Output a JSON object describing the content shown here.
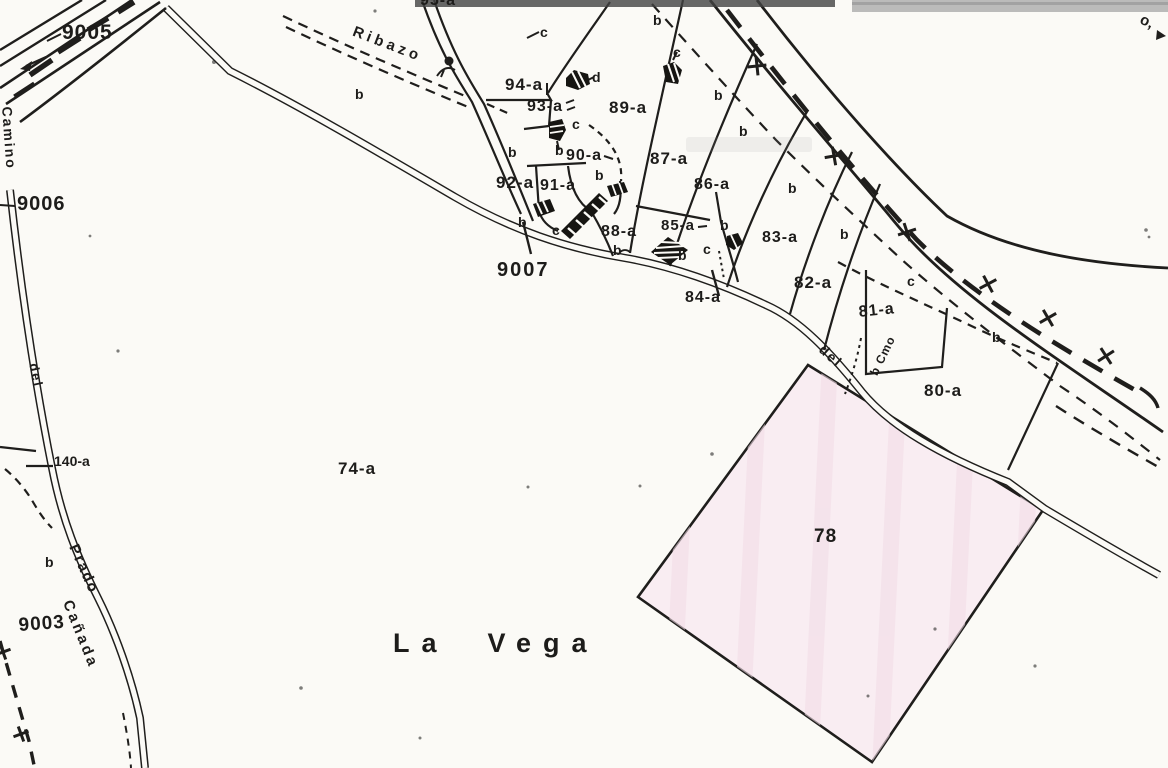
{
  "meta": {
    "kind": "scanned cadastral parcel map",
    "place_name": "La Vega"
  },
  "colors": {
    "ink": "#1f1e1c",
    "paper": "#fbfaf6",
    "parcel78_fill": "#f9edf2",
    "parcel78_streak": "#f2dde7",
    "scan_band_dark": "#424242",
    "scan_band_light": "#a5a5a5"
  },
  "labels": [
    {
      "name": "parcel-label-9005",
      "cls": "num",
      "text": "9005",
      "x": 62,
      "y": 22,
      "size": 21,
      "rot": 0,
      "ls": 1
    },
    {
      "name": "parcel-label-9006",
      "cls": "num",
      "text": "9006",
      "x": 17,
      "y": 194,
      "size": 20,
      "rot": 0,
      "ls": 1
    },
    {
      "name": "parcel-label-9007",
      "cls": "num",
      "text": "9007",
      "x": 497,
      "y": 260,
      "size": 20,
      "rot": 0,
      "ls": 2
    },
    {
      "name": "parcel-label-9003",
      "cls": "num",
      "text": "9003",
      "x": 18,
      "y": 616,
      "size": 19,
      "rot": -4,
      "ls": 1
    },
    {
      "name": "parcel-label-95a",
      "cls": "num",
      "text": "95-a",
      "x": 420,
      "y": -7,
      "size": 16,
      "rot": 0,
      "ls": 1
    },
    {
      "name": "parcel-label-94a",
      "cls": "num",
      "text": "94-a",
      "x": 505,
      "y": 76,
      "size": 17,
      "rot": 0,
      "ls": 1
    },
    {
      "name": "parcel-label-93a",
      "cls": "num",
      "text": "93-a",
      "x": 527,
      "y": 99,
      "size": 16,
      "rot": 0,
      "ls": 1
    },
    {
      "name": "parcel-label-92a",
      "cls": "num",
      "text": "92-a",
      "x": 496,
      "y": 174,
      "size": 17,
      "rot": 0,
      "ls": 1
    },
    {
      "name": "parcel-label-91a",
      "cls": "num",
      "text": "91-a",
      "x": 540,
      "y": 178,
      "size": 16,
      "rot": 0,
      "ls": 1
    },
    {
      "name": "parcel-label-90a",
      "cls": "num",
      "text": "90-a",
      "x": 566,
      "y": 148,
      "size": 16,
      "rot": 0,
      "ls": 1
    },
    {
      "name": "parcel-label-89a",
      "cls": "num",
      "text": "89-a",
      "x": 609,
      "y": 99,
      "size": 17,
      "rot": 0,
      "ls": 1
    },
    {
      "name": "parcel-label-88a",
      "cls": "num",
      "text": "88-a",
      "x": 601,
      "y": 224,
      "size": 16,
      "rot": 0,
      "ls": 1
    },
    {
      "name": "parcel-label-87a",
      "cls": "num",
      "text": "87-a",
      "x": 650,
      "y": 150,
      "size": 17,
      "rot": 0,
      "ls": 1
    },
    {
      "name": "parcel-label-86a",
      "cls": "num",
      "text": "86-a",
      "x": 694,
      "y": 177,
      "size": 16,
      "rot": 0,
      "ls": 1
    },
    {
      "name": "parcel-label-85a",
      "cls": "num",
      "text": "85-a",
      "x": 661,
      "y": 218,
      "size": 15,
      "rot": 0,
      "ls": 1
    },
    {
      "name": "parcel-label-84a",
      "cls": "num",
      "text": "84-a",
      "x": 685,
      "y": 290,
      "size": 16,
      "rot": 0,
      "ls": 1
    },
    {
      "name": "parcel-label-83a",
      "cls": "num",
      "text": "83-a",
      "x": 762,
      "y": 230,
      "size": 16,
      "rot": 0,
      "ls": 1
    },
    {
      "name": "parcel-label-82a",
      "cls": "num",
      "text": "82-a",
      "x": 794,
      "y": 274,
      "size": 17,
      "rot": 0,
      "ls": 1
    },
    {
      "name": "parcel-label-81a",
      "cls": "num",
      "text": "81-a",
      "x": 858,
      "y": 305,
      "size": 16,
      "rot": -6,
      "ls": 1
    },
    {
      "name": "parcel-label-80a",
      "cls": "num",
      "text": "80-a",
      "x": 924,
      "y": 382,
      "size": 17,
      "rot": 0,
      "ls": 1
    },
    {
      "name": "parcel-label-78",
      "cls": "num",
      "text": "78",
      "x": 814,
      "y": 527,
      "size": 19,
      "rot": 0,
      "ls": 1
    },
    {
      "name": "parcel-label-74a",
      "cls": "num",
      "text": "74-a",
      "x": 338,
      "y": 460,
      "size": 17,
      "rot": 0,
      "ls": 1
    },
    {
      "name": "parcel-label-140a",
      "cls": "num",
      "text": "140-a",
      "x": 54,
      "y": 454,
      "size": 14,
      "rot": 0,
      "ls": 0
    },
    {
      "name": "place-name-la-vega",
      "cls": "place",
      "text": "La  Vega",
      "x": 393,
      "y": 630,
      "size": 27,
      "rot": 0,
      "ls": 12
    },
    {
      "name": "road-name-camino",
      "cls": "topo",
      "text": "Camino",
      "x": 14,
      "y": 106,
      "size": 14,
      "rot": 86,
      "ls": 2
    },
    {
      "name": "road-name-del-left",
      "cls": "topo",
      "text": "del",
      "x": 40,
      "y": 362,
      "size": 13,
      "rot": 78,
      "ls": 2
    },
    {
      "name": "road-name-prado",
      "cls": "topo",
      "text": "Prado",
      "x": 80,
      "y": 542,
      "size": 15,
      "rot": 66,
      "ls": 2
    },
    {
      "name": "road-name-canada",
      "cls": "topo",
      "text": "Cañada",
      "x": 74,
      "y": 598,
      "size": 15,
      "rot": 68,
      "ls": 3
    },
    {
      "name": "road-name-ribazo",
      "cls": "topo",
      "text": "Ribazo",
      "x": 356,
      "y": 24,
      "size": 15,
      "rot": 21,
      "ls": 4
    },
    {
      "name": "road-name-del-81",
      "cls": "topo",
      "text": "del",
      "x": 826,
      "y": 342,
      "size": 14,
      "rot": 42,
      "ls": 2
    },
    {
      "name": "road-abbrev-b-cmo",
      "cls": "topo",
      "text": "b Cmo",
      "x": 868,
      "y": 372,
      "size": 12,
      "rot": -64,
      "ls": 1
    },
    {
      "name": "edge-mark-o",
      "cls": "topo",
      "text": "o,",
      "x": 1144,
      "y": 12,
      "size": 15,
      "rot": 25,
      "ls": 0
    },
    {
      "name": "subclass-b-1",
      "cls": "sub",
      "text": "b",
      "x": 355,
      "y": 87,
      "size": 14,
      "rot": 0,
      "ls": 0
    },
    {
      "name": "subclass-b-2",
      "cls": "sub",
      "text": "b",
      "x": 508,
      "y": 145,
      "size": 14,
      "rot": 0,
      "ls": 0
    },
    {
      "name": "subclass-b-3",
      "cls": "sub",
      "text": "b",
      "x": 518,
      "y": 215,
      "size": 14,
      "rot": 0,
      "ls": 0
    },
    {
      "name": "subclass-b-4",
      "cls": "sub",
      "text": "b",
      "x": 555,
      "y": 143,
      "size": 14,
      "rot": 0,
      "ls": 0
    },
    {
      "name": "subclass-b-5",
      "cls": "sub",
      "text": "b",
      "x": 595,
      "y": 168,
      "size": 14,
      "rot": 0,
      "ls": 0
    },
    {
      "name": "subclass-b-6",
      "cls": "sub",
      "text": "b",
      "x": 613,
      "y": 243,
      "size": 14,
      "rot": 0,
      "ls": 0
    },
    {
      "name": "subclass-b-7",
      "cls": "sub",
      "text": "b",
      "x": 678,
      "y": 248,
      "size": 14,
      "rot": 0,
      "ls": 0
    },
    {
      "name": "subclass-b-8",
      "cls": "sub",
      "text": "b",
      "x": 653,
      "y": 13,
      "size": 14,
      "rot": 0,
      "ls": 0
    },
    {
      "name": "subclass-b-9",
      "cls": "sub",
      "text": "b",
      "x": 714,
      "y": 88,
      "size": 14,
      "rot": 0,
      "ls": 0
    },
    {
      "name": "subclass-b-10",
      "cls": "sub",
      "text": "b",
      "x": 739,
      "y": 124,
      "size": 14,
      "rot": 0,
      "ls": 0
    },
    {
      "name": "subclass-b-11",
      "cls": "sub",
      "text": "b",
      "x": 788,
      "y": 181,
      "size": 14,
      "rot": 0,
      "ls": 0
    },
    {
      "name": "subclass-b-12",
      "cls": "sub",
      "text": "b",
      "x": 840,
      "y": 227,
      "size": 14,
      "rot": 0,
      "ls": 0
    },
    {
      "name": "subclass-b-13",
      "cls": "sub",
      "text": "b",
      "x": 720,
      "y": 218,
      "size": 14,
      "rot": 0,
      "ls": 0
    },
    {
      "name": "subclass-b-14",
      "cls": "sub",
      "text": "b",
      "x": 992,
      "y": 330,
      "size": 14,
      "rot": 0,
      "ls": 0
    },
    {
      "name": "subclass-b-15",
      "cls": "sub",
      "text": "b",
      "x": 45,
      "y": 555,
      "size": 14,
      "rot": 0,
      "ls": 0
    },
    {
      "name": "subclass-c-1",
      "cls": "sub",
      "text": "c",
      "x": 540,
      "y": 25,
      "size": 14,
      "rot": 0,
      "ls": 0
    },
    {
      "name": "subclass-c-2",
      "cls": "sub",
      "text": "c",
      "x": 572,
      "y": 117,
      "size": 14,
      "rot": 0,
      "ls": 0
    },
    {
      "name": "subclass-c-3",
      "cls": "sub",
      "text": "c",
      "x": 552,
      "y": 223,
      "size": 14,
      "rot": 0,
      "ls": 0
    },
    {
      "name": "subclass-c-4",
      "cls": "sub",
      "text": "c",
      "x": 703,
      "y": 242,
      "size": 14,
      "rot": 0,
      "ls": 0
    },
    {
      "name": "subclass-c-5",
      "cls": "sub",
      "text": "c",
      "x": 673,
      "y": 45,
      "size": 14,
      "rot": 0,
      "ls": 0
    },
    {
      "name": "subclass-c-6",
      "cls": "sub",
      "text": "c",
      "x": 907,
      "y": 274,
      "size": 14,
      "rot": 0,
      "ls": 0
    },
    {
      "name": "subclass-d-1",
      "cls": "sub",
      "text": "d",
      "x": 592,
      "y": 70,
      "size": 14,
      "rot": 0,
      "ls": 0
    }
  ]
}
